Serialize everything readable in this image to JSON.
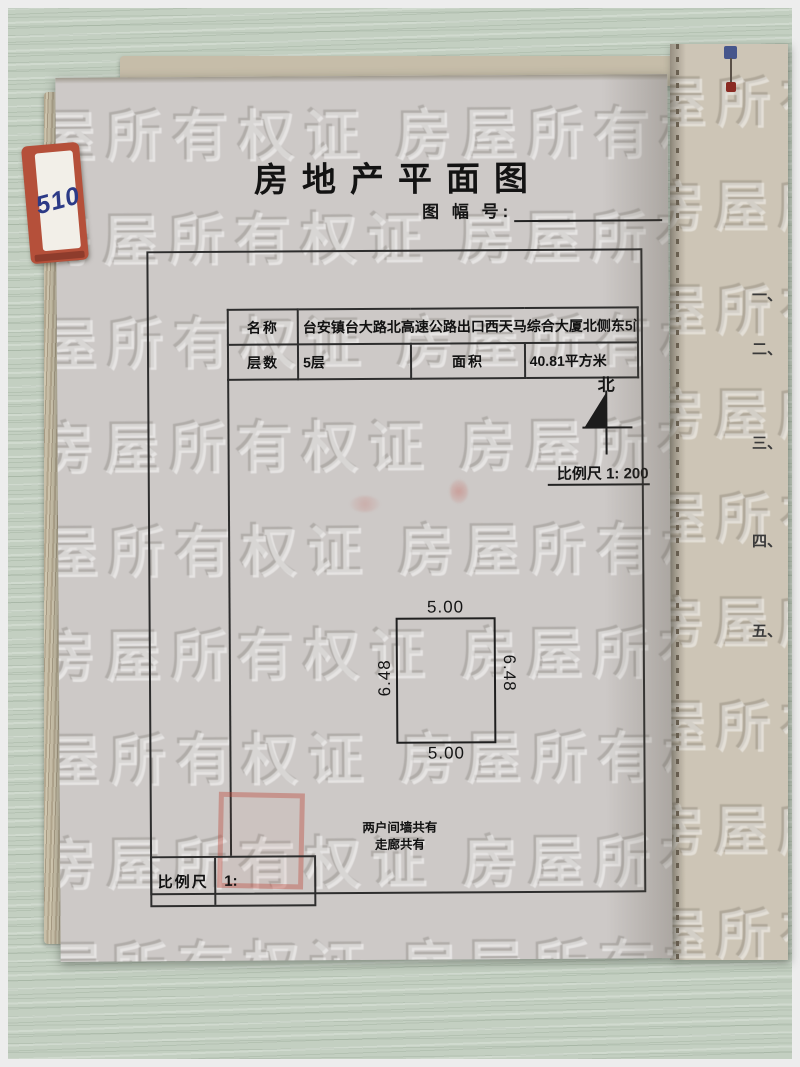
{
  "page_title": "房地产平面图",
  "sheet_label": "图 幅 号:",
  "info_table": {
    "name_label": "名称",
    "name_value": "台安镇台大路北高速公路出口西天马综合大厦北侧东5间",
    "floors_label": "层数",
    "floors_value": "5层",
    "area_label": "面积",
    "area_value": "40.81平方米"
  },
  "compass": {
    "north_label": "北",
    "scale_text": "比例尺 1: 200"
  },
  "floor_plan": {
    "dim_top": "5.00",
    "dim_bottom": "5.00",
    "dim_left": "6.48",
    "dim_right": "6.48",
    "note_line1": "两户间墙共有",
    "note_line2": "走廊共有"
  },
  "bottom_scale": {
    "label": "比例尺",
    "value": "1:"
  },
  "tab_sticker": {
    "text": "510"
  },
  "side_page": {
    "items": [
      "一、",
      "二、",
      "三、",
      "四、",
      "五、"
    ]
  },
  "watermark_text": "房屋所有权证",
  "colors": {
    "desk_green": "#c3cfc1",
    "page_gray": "#cdc9c7",
    "side_page_tan": "#cdc5b6",
    "line_black": "#2d2d2d",
    "stamp_red": "#be463a",
    "tab_red": "#b5503a",
    "ink_blue": "#2c3a86"
  }
}
